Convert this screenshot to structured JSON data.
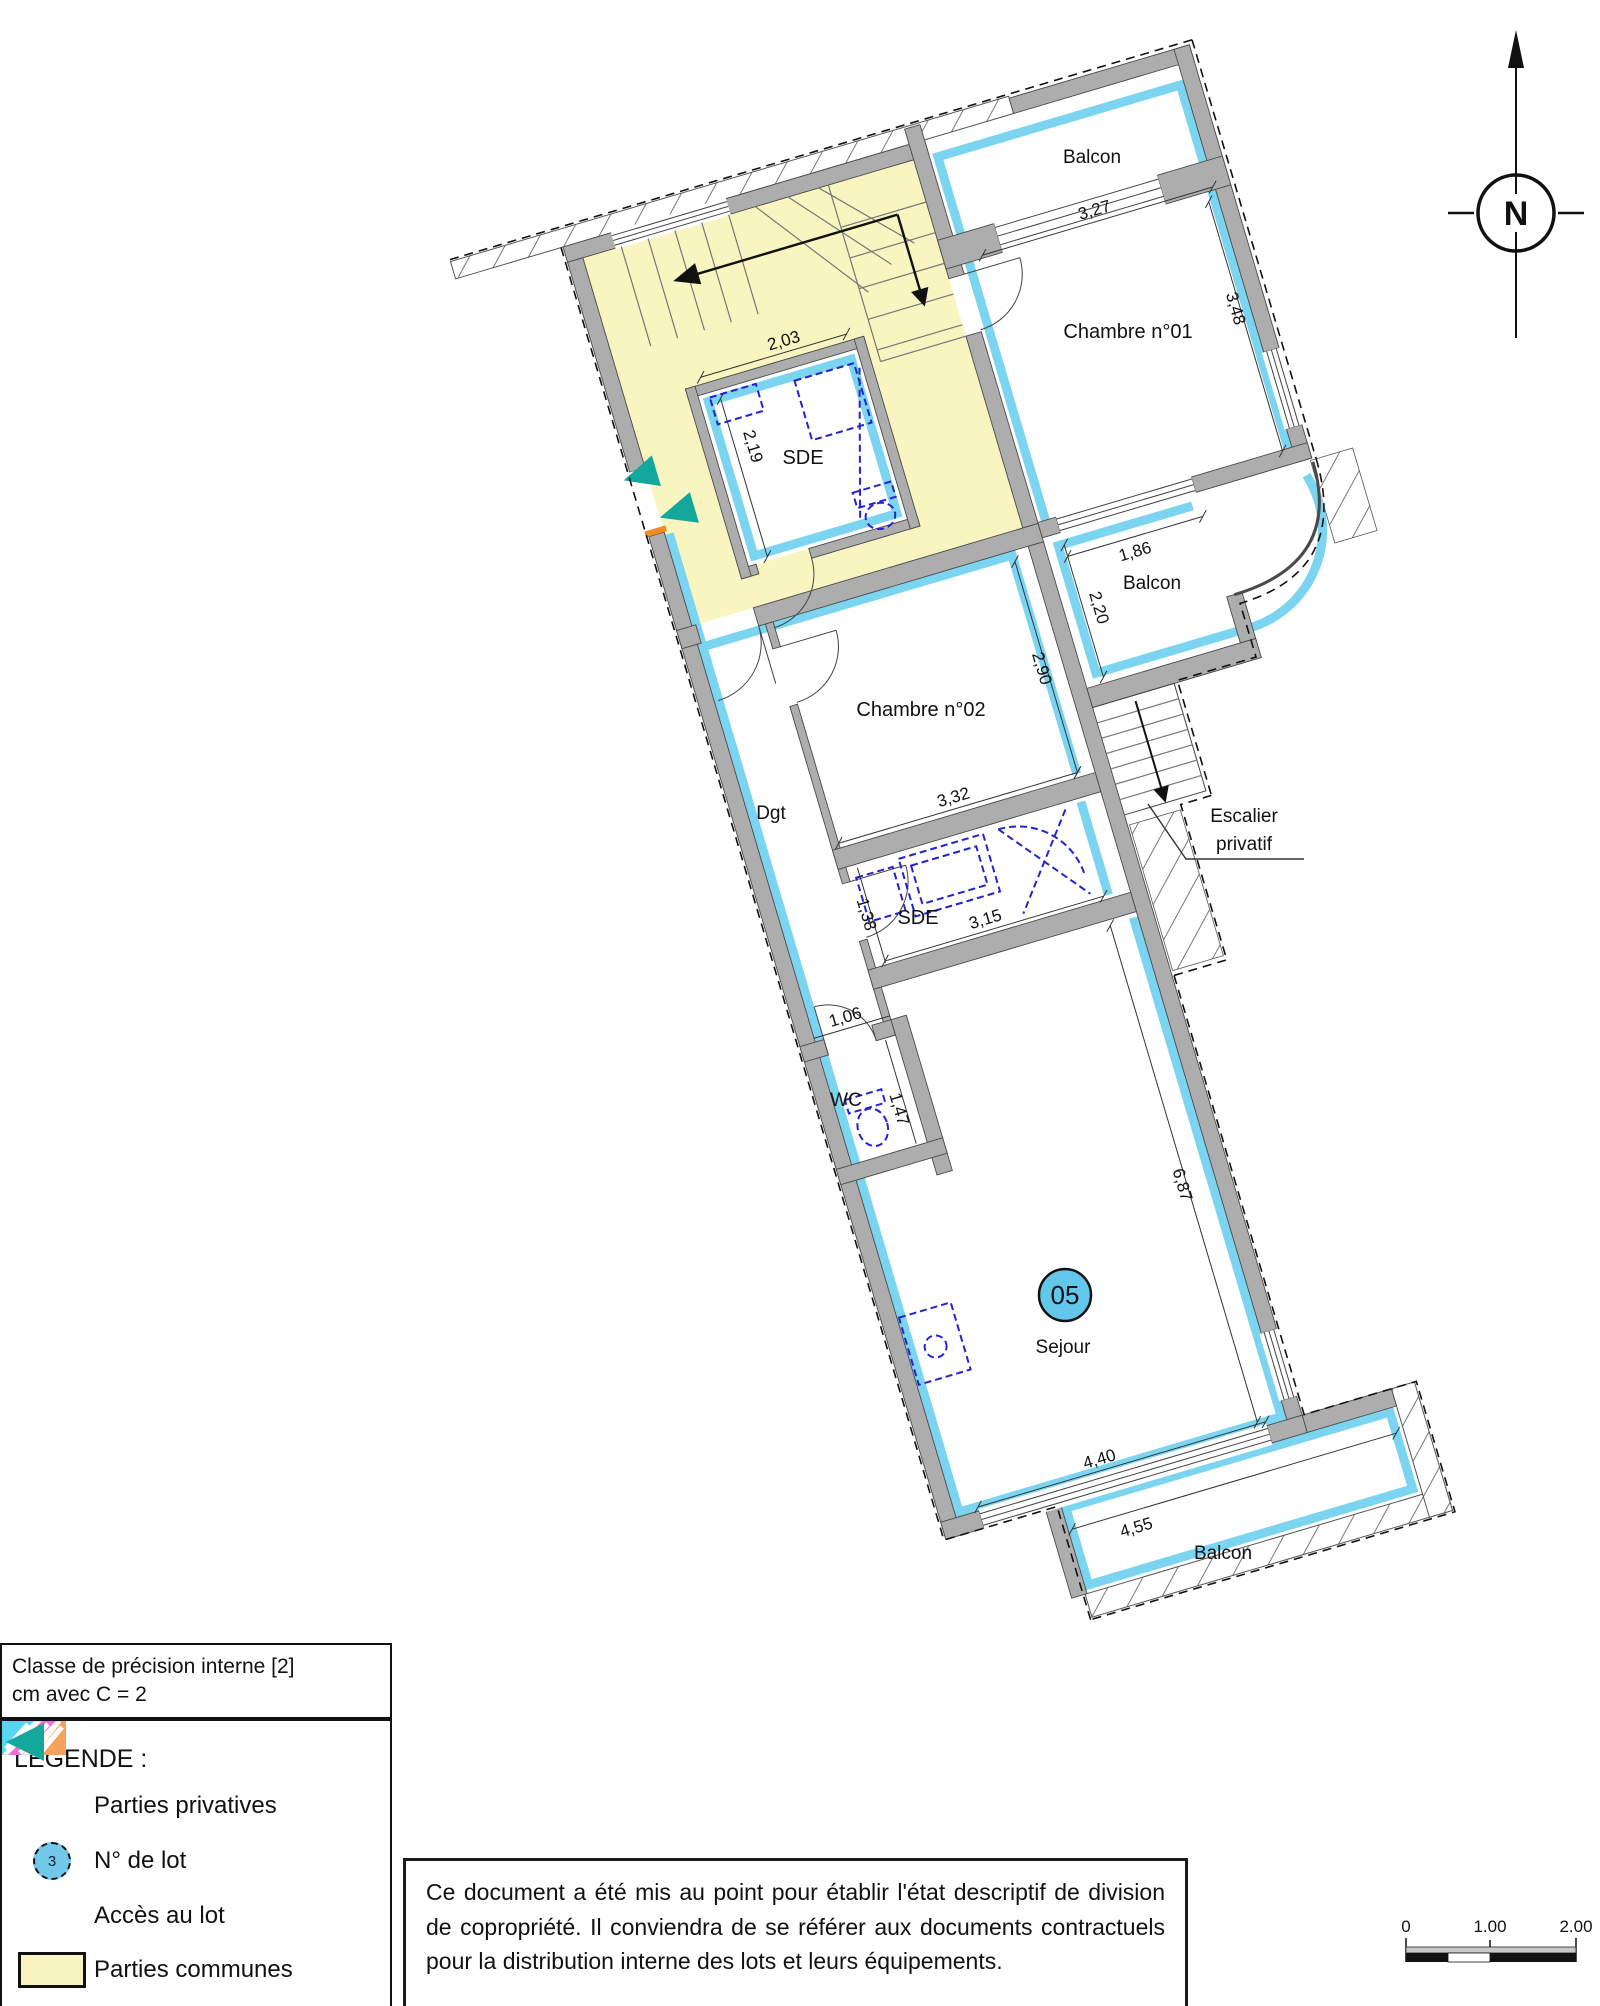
{
  "plan": {
    "lot_badge": "05",
    "labels": {
      "balcon_top": "Balcon",
      "chambre01": "Chambre n°01",
      "sde1": "SDE",
      "balcon_mid": "Balcon",
      "chambre02": "Chambre n°02",
      "dgt": "Dgt",
      "escalier_1": "Escalier",
      "escalier_2": "privatif",
      "sde2": "SDE",
      "wc": "WC",
      "sejour": "Sejour",
      "balcon_bottom": "Balcon"
    },
    "dimensions": {
      "balcon_top_w": "3,27",
      "chambre01_h": "3,48",
      "sde1_w": "2,03",
      "sde1_h": "2,19",
      "balcon_mid_w": "1,86",
      "balcon_mid_h": "2,20",
      "chambre02_w": "3,32",
      "chambre02_h": "2,90",
      "sde2_w": "3,15",
      "sde2_h": "1,38",
      "wc_w": "1,06",
      "wc_h": "1,47",
      "sejour_h": "6,87",
      "sejour_w": "4,40",
      "balcon_bottom_w": "4,55"
    }
  },
  "compass": {
    "label": "N"
  },
  "precision_box": {
    "line1": "Classe de précision interne [2]",
    "line2": "cm avec C = 2"
  },
  "legend": {
    "title": "LEGENDE :",
    "items": [
      {
        "label": "Parties privatives"
      },
      {
        "symbol_text": "3",
        "label": "N° de lot"
      },
      {
        "label": "Accès au lot"
      },
      {
        "label": "Parties communes"
      }
    ]
  },
  "note": {
    "text": "Ce document a été mis au point pour établir l'état descriptif de division de copropriété. Il conviendra de se référer aux documents contractuels pour la distribution interne des lots et leurs équipements."
  },
  "scale_bar": {
    "ticks": [
      "0",
      "1.00",
      "2.00"
    ]
  },
  "colors": {
    "private_boundary": "#7BD4F0",
    "common_area": "#F8F5C1",
    "access_marker": "#14A79B",
    "wall": "#ADADAD",
    "fixtures": "#2424CF",
    "lot_badge_fill": "#63C7EA"
  }
}
